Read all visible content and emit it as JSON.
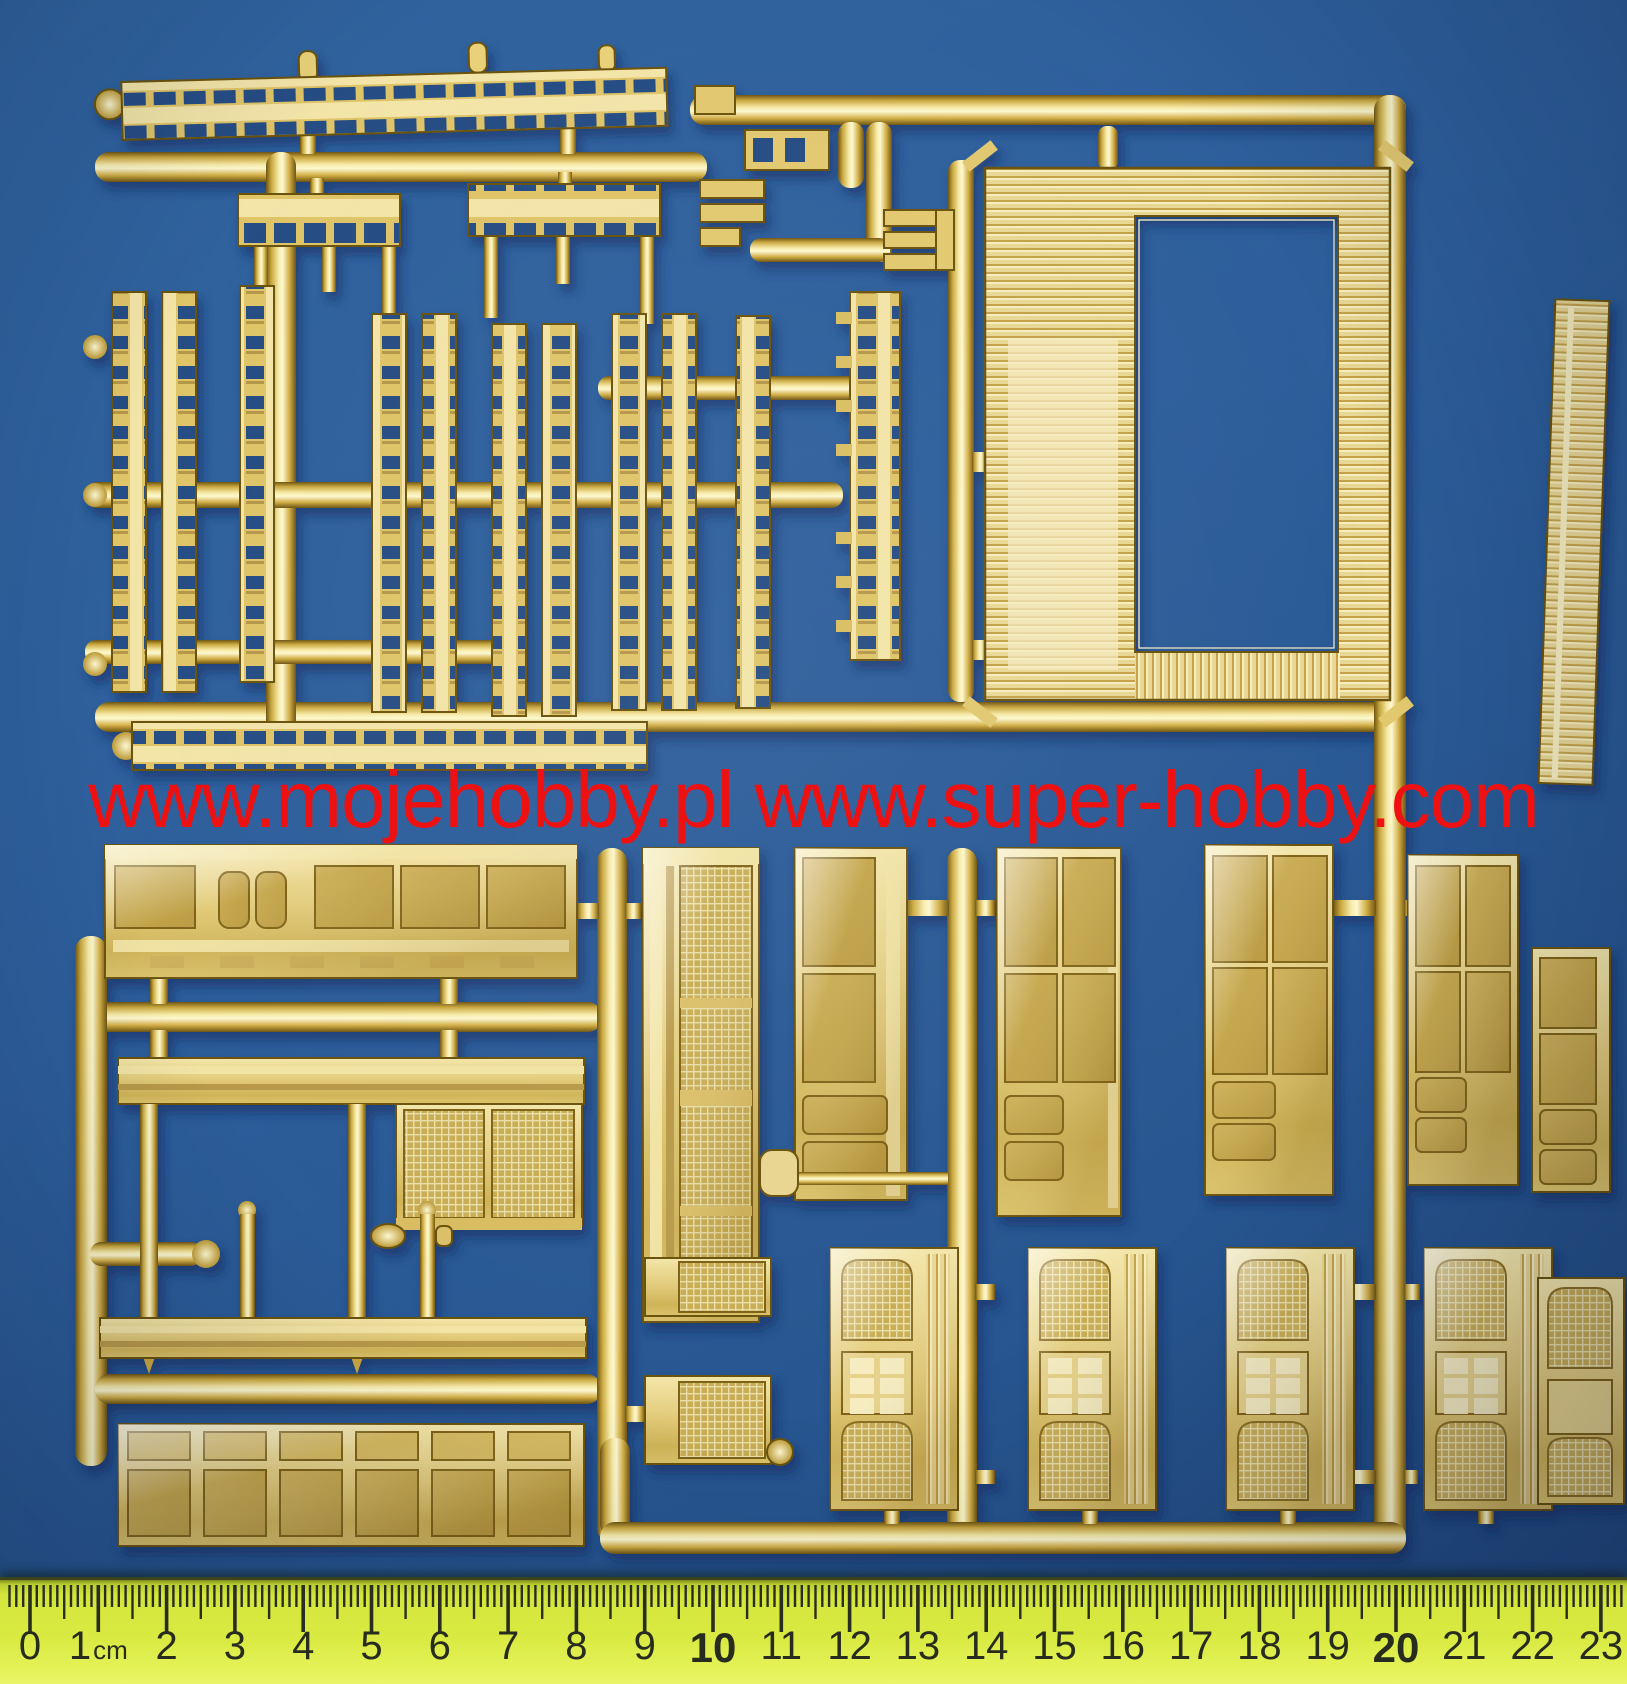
{
  "photo": {
    "watermark": {
      "text": "www.mojehobby.pl www.super-hobby.com"
    }
  },
  "ruler": {
    "cm_labels": [
      "0",
      "1",
      "2",
      "3",
      "4",
      "5",
      "6",
      "7",
      "8",
      "9",
      "10",
      "11",
      "12",
      "13",
      "14",
      "15",
      "16",
      "17",
      "18",
      "19",
      "20",
      "21",
      "22",
      "23"
    ],
    "unit_label": "cm",
    "unit_after_value": "1",
    "bold_values": [
      "10",
      "20"
    ]
  },
  "colors": {
    "background_blue": "#2e5f9c",
    "sprue_gold": "#e6cf7c",
    "sprue_gold_deep": "#c8a43e",
    "watermark_red": "#ee1111",
    "ruler_yellow": "#d9ea42",
    "tick_dark": "#2a2e20"
  }
}
